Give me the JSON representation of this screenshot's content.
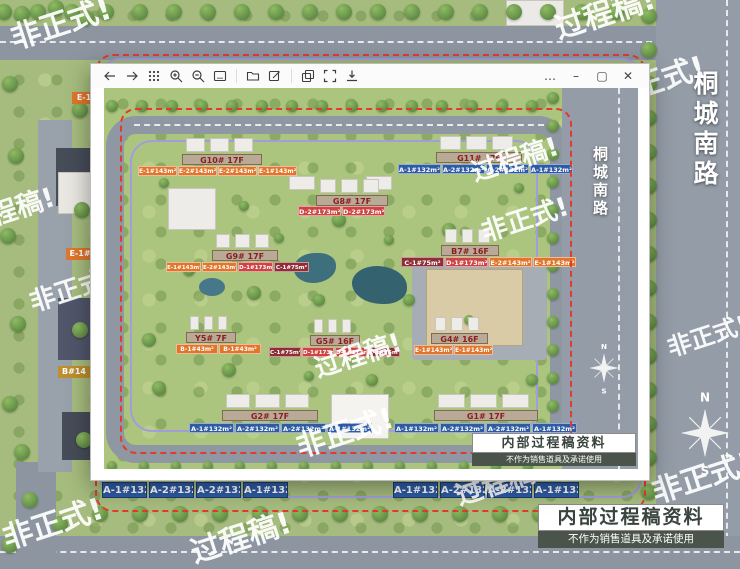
{
  "window": {
    "toolbar": {
      "icons": [
        "back",
        "forward",
        "grid-view",
        "zoom-in",
        "zoom-out",
        "slideshow",
        "folder",
        "edit",
        "copy",
        "fullscreen",
        "save"
      ],
      "controls": {
        "more": "…",
        "minimize": "–",
        "maximize": "▢",
        "close": "✕"
      }
    }
  },
  "site_plan": {
    "outer_road_label": "桐城南路",
    "inner_road_label": "桐城南路",
    "compass": {
      "north": "N",
      "south": "S"
    },
    "notice_outer": {
      "title": "内部过程稿资料",
      "subtitle": "不作为销售道具及承诺使用"
    },
    "notice_inner": {
      "title": "内部过程稿资料",
      "subtitle": "不作为销售道具及承诺使用"
    },
    "buildings": [
      {
        "name": "G10# 17F",
        "hx": 78,
        "hy": 66,
        "hw": 80,
        "ux": 34,
        "uy": 78,
        "uw": 39,
        "units": [
          {
            "label": "E-1#143m²",
            "type": "orange"
          },
          {
            "label": "E-2#143m²",
            "type": "orange"
          },
          {
            "label": "E-2#143m²",
            "type": "orange"
          },
          {
            "label": "E-1#143m²",
            "type": "orange"
          }
        ]
      },
      {
        "name": "G11# 17F",
        "hx": 332,
        "hy": 64,
        "hw": 86,
        "ux": 294,
        "uy": 76,
        "uw": 43,
        "units": [
          {
            "label": "A-1#132m²",
            "type": "blue"
          },
          {
            "label": "A-2#132m²",
            "type": "blue"
          },
          {
            "label": "A-2#132m²",
            "type": "blue"
          },
          {
            "label": "A-1#132m²",
            "type": "blue"
          }
        ]
      },
      {
        "name": "G8# 17F",
        "hx": 212,
        "hy": 107,
        "hw": 72,
        "ux": 194,
        "uy": 118,
        "uw": 43,
        "units": [
          {
            "label": "D-2#173m²",
            "type": "red"
          },
          {
            "label": "D-2#173m²",
            "type": "red"
          }
        ]
      },
      {
        "name": "G9# 17F",
        "hx": 108,
        "hy": 162,
        "hw": 66,
        "ux": 62,
        "uy": 174,
        "uw": 35,
        "units": [
          {
            "label": "E-1#143m²",
            "type": "orange"
          },
          {
            "label": "E-2#143m²",
            "type": "orange"
          },
          {
            "label": "D-1#173m²",
            "type": "red"
          },
          {
            "label": "C-1#75m²",
            "type": "maroon"
          }
        ]
      },
      {
        "name": "B7# 16F",
        "hx": 337,
        "hy": 157,
        "hw": 58,
        "ux": 297,
        "uy": 169,
        "uw": 43,
        "units": [
          {
            "label": "C-1#75m²",
            "type": "maroon"
          },
          {
            "label": "D-1#173m²",
            "type": "red"
          },
          {
            "label": "E-2#143m²",
            "type": "orange"
          },
          {
            "label": "E-1#143m²",
            "type": "orange"
          }
        ]
      },
      {
        "name": "Y5# 7F",
        "hx": 82,
        "hy": 244,
        "hw": 50,
        "ux": 72,
        "uy": 256,
        "uw": 42,
        "units": [
          {
            "label": "B-1#43m²",
            "type": "orange"
          },
          {
            "label": "B-1#43m²",
            "type": "orange"
          }
        ]
      },
      {
        "name": "G5# 16F",
        "hx": 206,
        "hy": 247,
        "hw": 50,
        "ux": 165,
        "uy": 259,
        "uw": 32,
        "units": [
          {
            "label": "C-1#75m²",
            "type": "maroon"
          },
          {
            "label": "D-1#173m²",
            "type": "red"
          },
          {
            "label": "D-1#173m²",
            "type": "red"
          },
          {
            "label": "C-1#75m²",
            "type": "maroon"
          }
        ]
      },
      {
        "name": "G4# 16F",
        "hx": 327,
        "hy": 245,
        "hw": 57,
        "ux": 310,
        "uy": 257,
        "uw": 39,
        "units": [
          {
            "label": "E-1#143m²",
            "type": "orange"
          },
          {
            "label": "E-1#143m²",
            "type": "orange"
          }
        ]
      },
      {
        "name": "G2# 17F",
        "hx": 118,
        "hy": 322,
        "hw": 96,
        "ux": 85,
        "uy": 335,
        "uw": 45,
        "units": [
          {
            "label": "A-1#132m²",
            "type": "blue"
          },
          {
            "label": "A-2#132m²",
            "type": "blue"
          },
          {
            "label": "A-2#132m²",
            "type": "blue"
          },
          {
            "label": "A-1#132m²",
            "type": "blue"
          }
        ]
      },
      {
        "name": "G1# 17F",
        "hx": 330,
        "hy": 322,
        "hw": 104,
        "ux": 290,
        "uy": 335,
        "uw": 45,
        "units": [
          {
            "label": "A-1#132m²",
            "type": "blue"
          },
          {
            "label": "A-2#132m²",
            "type": "blue"
          },
          {
            "label": "A-2#132m²",
            "type": "blue"
          },
          {
            "label": "A-1#132m²",
            "type": "blue"
          }
        ]
      }
    ],
    "left_fragments": [
      {
        "text": "E-1",
        "x": 72,
        "y": 92,
        "w": 24,
        "type": "orange"
      },
      {
        "text": "E-1#",
        "x": 66,
        "y": 248,
        "w": 28,
        "type": "orange"
      },
      {
        "text": "B#14",
        "x": 58,
        "y": 366,
        "w": 32,
        "type": "olive"
      }
    ],
    "bottom_labels": {
      "groups": [
        {
          "x": 102,
          "items": [
            "A-1#132m²",
            "A-2#132m²",
            "A-2#132m²",
            "A-1#132m²"
          ]
        },
        {
          "x": 393,
          "items": [
            "A-1#132m²",
            "A-2#132m²",
            "A-2#132m²",
            "A-1#132m²"
          ]
        }
      ]
    }
  },
  "watermarks": {
    "background": [
      {
        "text": "非正式!",
        "x": 4,
        "y": 16,
        "size": 30
      },
      {
        "text": "过程稿!",
        "x": 548,
        "y": 6,
        "size": 30
      },
      {
        "text": "非正式!",
        "x": 598,
        "y": 74,
        "size": 30
      },
      {
        "text": "程稿!",
        "x": -16,
        "y": 196,
        "size": 27
      },
      {
        "text": "非正式!",
        "x": 24,
        "y": 284,
        "size": 26
      },
      {
        "text": "非正式!",
        "x": 662,
        "y": 330,
        "size": 24
      },
      {
        "text": "非正式!",
        "x": -4,
        "y": 516,
        "size": 30
      },
      {
        "text": "过程稿!",
        "x": 184,
        "y": 530,
        "size": 30
      },
      {
        "text": "过程稿!",
        "x": 450,
        "y": 476,
        "size": 27
      },
      {
        "text": "非正式!",
        "x": 645,
        "y": 470,
        "size": 30
      }
    ],
    "viewer": [
      {
        "text": "过程稿!",
        "x": 362,
        "y": 66,
        "size": 26
      },
      {
        "text": "非正式!",
        "x": 372,
        "y": 126,
        "size": 26
      },
      {
        "text": "过程稿!",
        "x": 205,
        "y": 262,
        "size": 26
      },
      {
        "text": "非正式!",
        "x": 186,
        "y": 338,
        "size": 29
      }
    ]
  },
  "colors": {
    "orange": "#e0762c",
    "red": "#ce4343",
    "maroon": "#8e2f37",
    "blue": "#2e5ba4",
    "olive": "#bd8f2e",
    "header_bg": "#b9aa97",
    "header_text": "#8b1d1d",
    "boundary_red": "#e23b2e",
    "path_purple": "#a19ce0",
    "notice_dark_bg": "#4a544a"
  }
}
